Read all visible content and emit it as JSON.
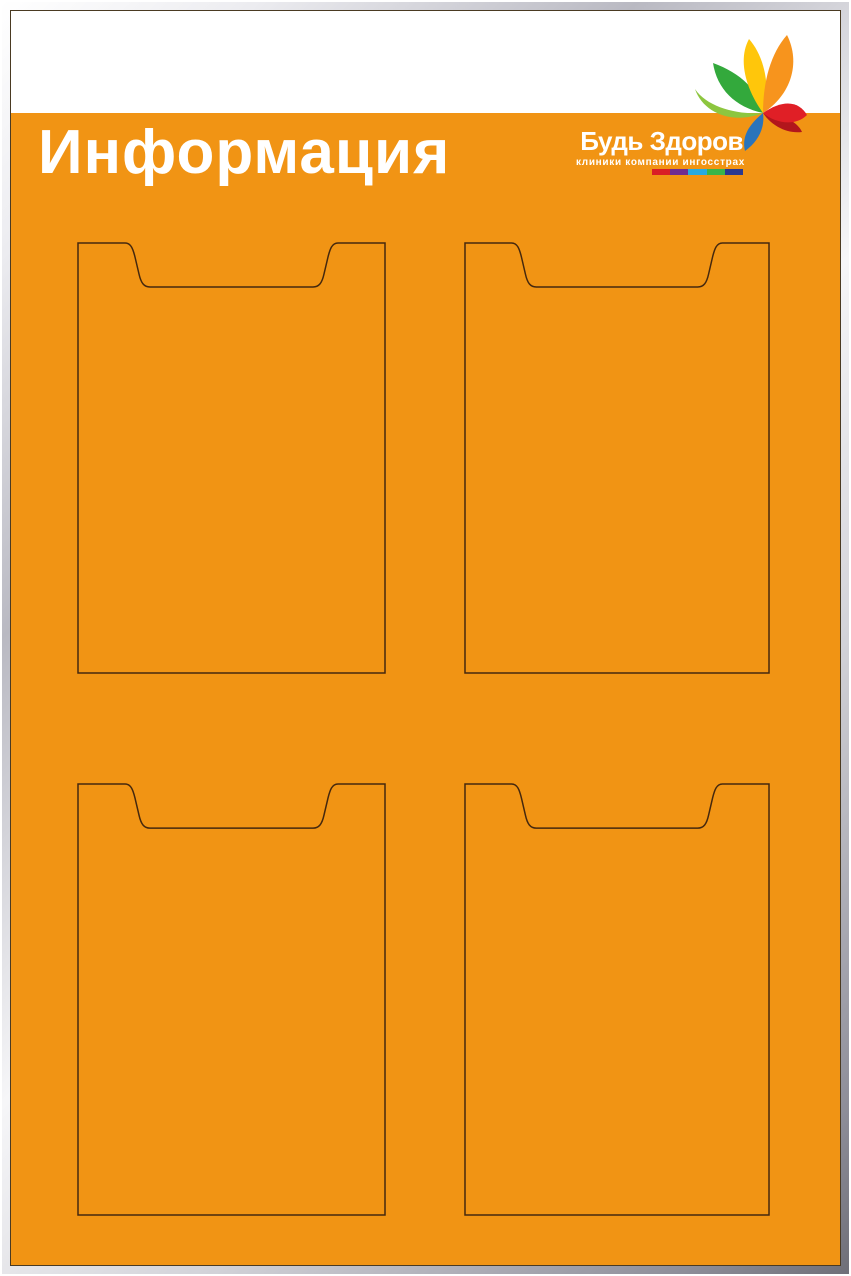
{
  "board": {
    "title": "Информация",
    "background_color": "#F19414",
    "header_band_color": "#FFFFFF",
    "pocket_outline_color": "#45280E",
    "frame_style": "silver-aluminium"
  },
  "logo": {
    "brand": "Будь Здоров",
    "tagline": "клиники компании ингосстрах",
    "stripe_colors": [
      "#D91F26",
      "#6F2C91",
      "#27AAE1",
      "#3AB54A",
      "#2B3990"
    ],
    "petals": [
      {
        "name": "light-green-petal",
        "color": "#8DC63F"
      },
      {
        "name": "green-petal",
        "color": "#33A93C"
      },
      {
        "name": "yellow-petal",
        "color": "#FFC60B"
      },
      {
        "name": "orange-petal",
        "color": "#F7941D"
      },
      {
        "name": "dark-red-petal",
        "color": "#B2161C"
      },
      {
        "name": "red-petal",
        "color": "#E01F26"
      },
      {
        "name": "blue-petal",
        "color": "#2A74BB"
      }
    ]
  },
  "pockets": [
    {
      "position": "top-left"
    },
    {
      "position": "top-right"
    },
    {
      "position": "bottom-left"
    },
    {
      "position": "bottom-right"
    }
  ]
}
